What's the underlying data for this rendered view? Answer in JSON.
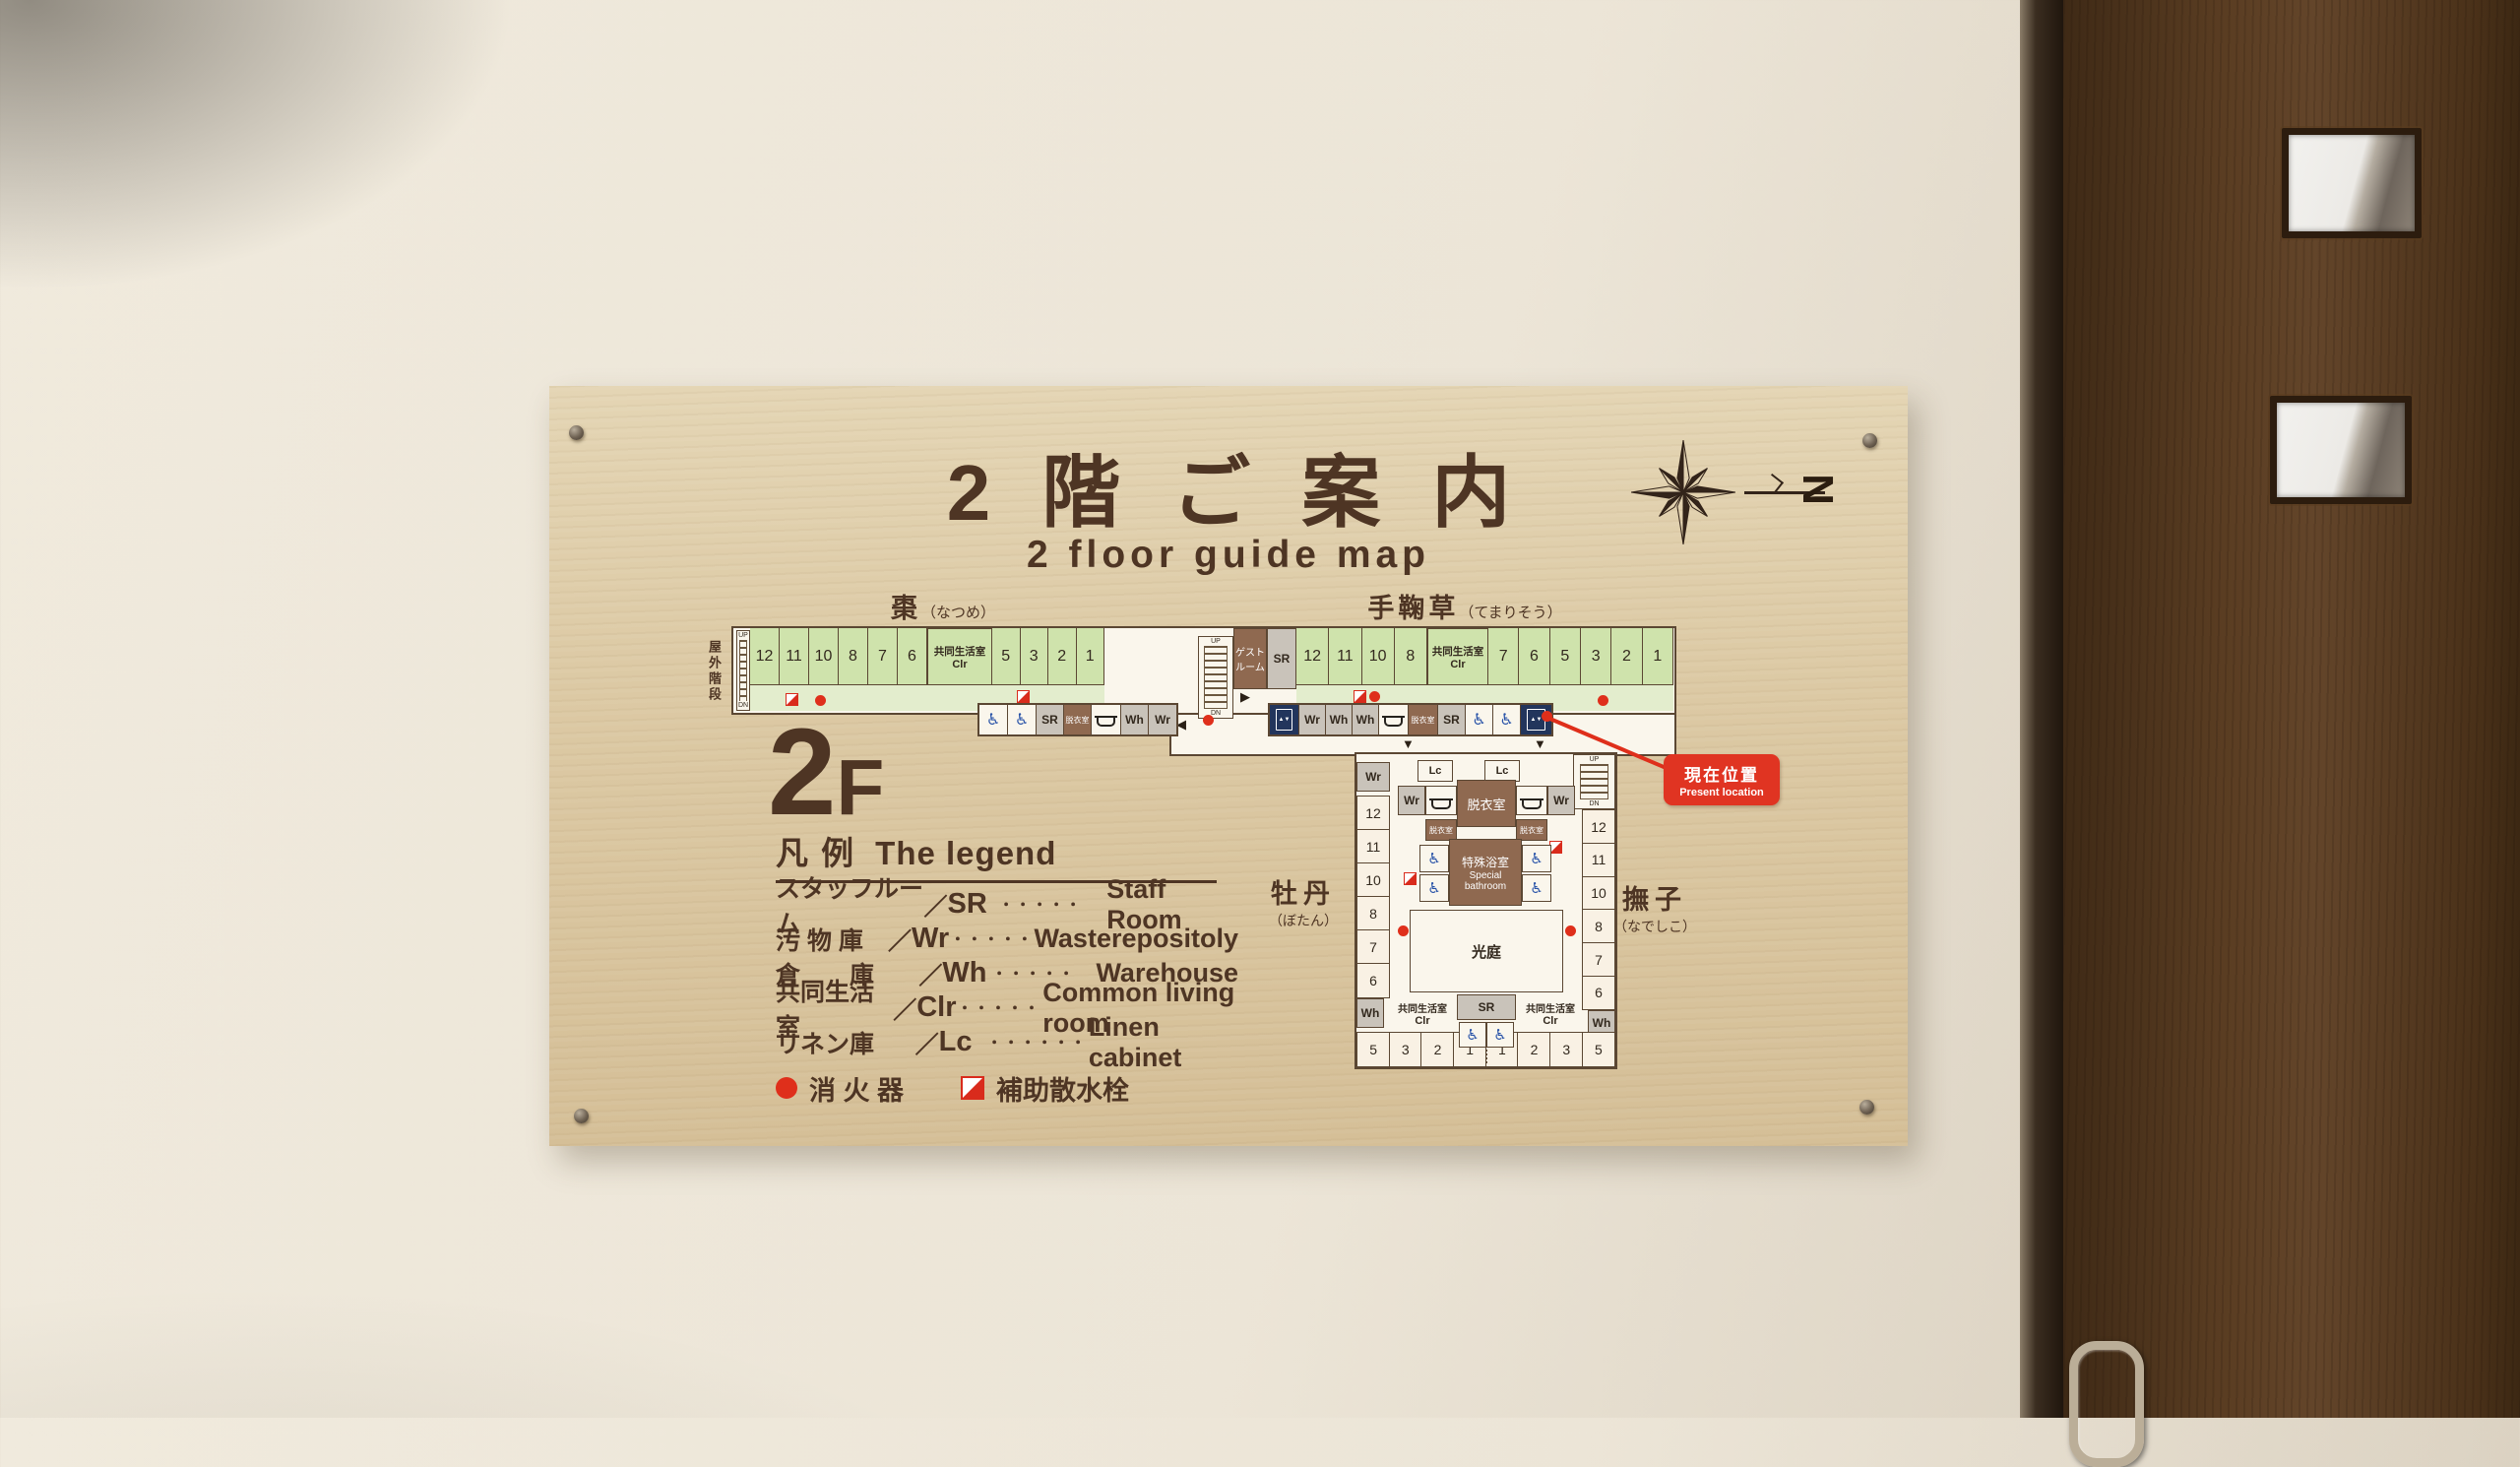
{
  "colors": {
    "board": "#dcc9a4",
    "ink": "#4e3524",
    "plan_bg": "#faf6ec",
    "plan_line": "#5b4733",
    "room_green": "#cfe3ac",
    "corridor_green": "#e3edcd",
    "room_cream": "#f9f1e4",
    "cell_gray": "#c9c3ba",
    "room_brown": "#8f6950",
    "red": "#df2f1b",
    "wheelchair_blue": "#2953a8",
    "elevator_navy": "#22355c",
    "door_wood": "#5a3d22"
  },
  "icons": {
    "wheelchair": "♿",
    "down_arrow": "▼",
    "left_arrow": "◀",
    "right_arrow": "▶"
  },
  "sign": {
    "title_jp": "2階ご案内",
    "subtitle_en": "2 floor guide map",
    "floor_big": "2",
    "floor_small": "F",
    "compass_letter": "N"
  },
  "plan": {
    "outdoor_stairs_jp": "屋外階段",
    "up": "UP",
    "dn": "DN",
    "left_wing": {
      "name": "棗",
      "kana": "（なつめ）",
      "rooms1": [
        "12",
        "11",
        "10",
        "8",
        "7",
        "6"
      ],
      "rooms2": [
        "5",
        "3",
        "2",
        "1"
      ]
    },
    "right_wing": {
      "name": "手鞠草",
      "kana": "（てまりそう）",
      "rooms1": [
        "12",
        "11",
        "10",
        "8"
      ],
      "rooms2": [
        "7",
        "6",
        "5",
        "3",
        "2",
        "1"
      ]
    },
    "clr_jp": "共同生活室",
    "clr_abbr": "Clr",
    "guest1": "ゲスト",
    "guest2": "ルーム",
    "sr": "SR",
    "svc_left": [
      {
        "i": "wheelchair",
        "w": 29
      },
      {
        "i": "wheelchair",
        "w": 29
      },
      {
        "t": "SR",
        "c": "gray",
        "w": 28
      },
      {
        "t": "脱衣室",
        "c": "brown",
        "w": 28
      },
      {
        "i": "bath",
        "w": 30
      },
      {
        "t": "Wh",
        "c": "gray",
        "w": 28
      },
      {
        "t": "Wr",
        "c": "gray",
        "w": 28
      }
    ],
    "svc_right": [
      {
        "i": "elevator",
        "c": "ev",
        "w": 30
      },
      {
        "t": "Wr",
        "c": "gray",
        "w": 27
      },
      {
        "t": "Wh",
        "c": "gray",
        "w": 27
      },
      {
        "t": "Wh",
        "c": "gray",
        "w": 27
      },
      {
        "i": "bath",
        "w": 30
      },
      {
        "t": "脱衣室",
        "c": "brown",
        "w": 30
      },
      {
        "t": "SR",
        "c": "gray",
        "w": 28
      },
      {
        "i": "wheelchair",
        "w": 28
      },
      {
        "i": "wheelchair",
        "w": 28
      },
      {
        "i": "elevator",
        "c": "ev",
        "w": 31
      }
    ],
    "block": {
      "name_left": "牡丹",
      "kana_left": "（ぼたん）",
      "name_right": "撫子",
      "kana_right": "（なでしこ）",
      "col_left": [
        "12",
        "11",
        "10",
        "8",
        "7",
        "6"
      ],
      "col_right": [
        "12",
        "11",
        "10",
        "8",
        "7",
        "6"
      ],
      "bottom": [
        "5",
        "3",
        "2",
        "1",
        "1",
        "2",
        "3",
        "5"
      ],
      "wr": "Wr",
      "wh": "Wh",
      "lc": "Lc",
      "sr": "SR",
      "datsui": "脱衣室",
      "special_jp": "特殊浴室",
      "special_en1": "Special",
      "special_en2": "bathroom",
      "koutei": "光庭",
      "clr_jp": "共同生活室",
      "clr_abbr": "Clr"
    },
    "present": {
      "jp": "現在位置",
      "en": "Present location"
    }
  },
  "legend": {
    "heading_jp": "凡 例",
    "heading_en": "The legend",
    "slash": "／",
    "rows": [
      {
        "jp": "スタッフルーム",
        "abbr": "SR",
        "dots": "・・・・・",
        "en": "Staff Room"
      },
      {
        "jp": "汚 物 庫",
        "abbr": "Wr",
        "dots": "・・・・・",
        "en": "Wasterepositoly"
      },
      {
        "jp": "倉　　庫",
        "abbr": "Wh",
        "dots": "・・・・・",
        "en": "Warehouse"
      },
      {
        "jp": "共同生活室",
        "abbr": "Clr",
        "dots": "・・・・・",
        "en": "Common living room"
      },
      {
        "jp": "リネン庫",
        "abbr": "Lc",
        "dots": "・・・・・・",
        "en": "Linen cabinet"
      }
    ],
    "fire_jp": "消 火 器",
    "sprinkler_jp": "補助散水栓"
  }
}
